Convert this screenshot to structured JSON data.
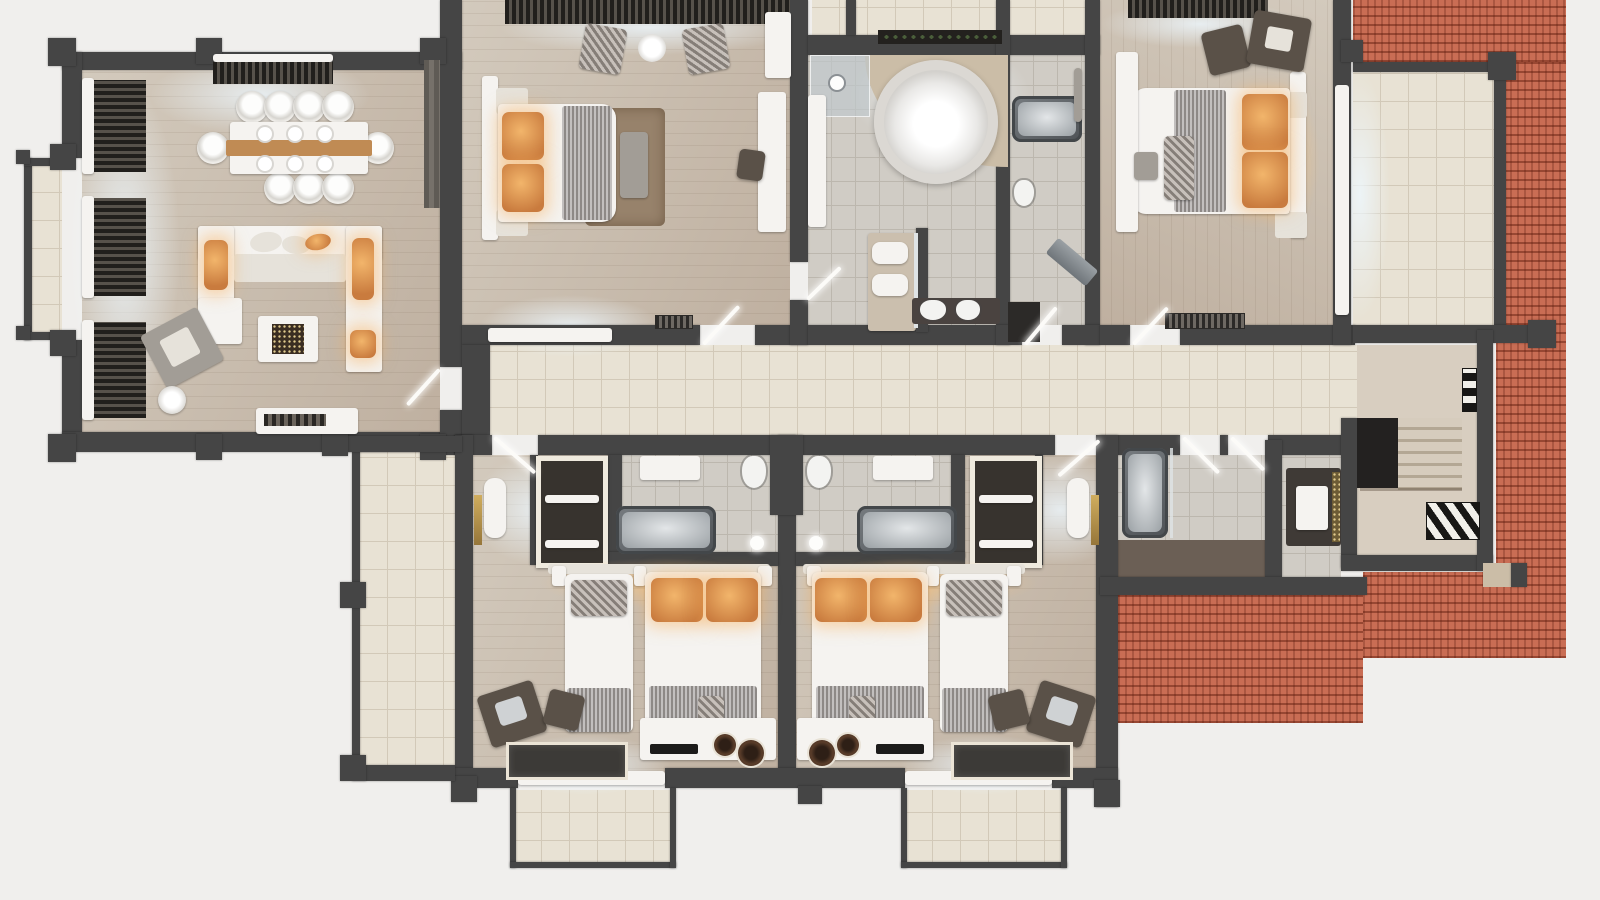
{
  "meta": {
    "kind": "3d-floor-plan-render",
    "view": "top-down-dollhouse",
    "width_px": 1600,
    "height_px": 900
  },
  "palette": {
    "bg": "#f0efed",
    "wall": "#454545",
    "wallL": "#6b6762",
    "wood": "#d3cabd",
    "wood2": "#bfb0a0",
    "tileC": "#e8e2d4",
    "tileCl": "#d2c9b8",
    "tileG": "#d0ccc5",
    "tileGl": "#bcb7ae",
    "stair": "#d8cec0",
    "roof": "#c96d54",
    "roofRow": "#8f3f2c",
    "white": "#f5f3f0",
    "soft": "#e6e2da",
    "gray": "#a29d96",
    "dark": "#5a5148",
    "darker": "#36322e",
    "orange": "#c97b3e",
    "orangeG": "#f2b56b",
    "blanket": "#a8a4a2",
    "brownRug": "#97826b",
    "glass": "#c3cacd",
    "steel": "#848a8e",
    "gold": "#bb9a54"
  },
  "rooms": {
    "living": {
      "name": "living-dining-room"
    },
    "bay": {
      "name": "bay-window"
    },
    "bedroom1": {
      "name": "bedroom-top-center"
    },
    "masterBath": {
      "name": "master-bathroom"
    },
    "bath2": {
      "name": "ensuite-bathroom"
    },
    "bedroom2": {
      "name": "bedroom-top-right"
    },
    "terraceTR": {
      "name": "roof-terrace-right"
    },
    "hallway": {
      "name": "hallway"
    },
    "stairs": {
      "name": "stairwell"
    },
    "roomA": {
      "name": "twin-guest-room-left"
    },
    "roomB": {
      "name": "twin-guest-room-right"
    },
    "bathA": {
      "name": "guest-bathroom-left"
    },
    "bathB": {
      "name": "guest-bathroom-right"
    },
    "bath3": {
      "name": "bathroom-center-right"
    },
    "wc": {
      "name": "wc-utility"
    },
    "terraceL": {
      "name": "side-terrace"
    },
    "balconyA": {
      "name": "balcony-bottom-left"
    },
    "balconyB": {
      "name": "balcony-bottom-right"
    },
    "roof": {
      "name": "red-tile-roof"
    }
  }
}
